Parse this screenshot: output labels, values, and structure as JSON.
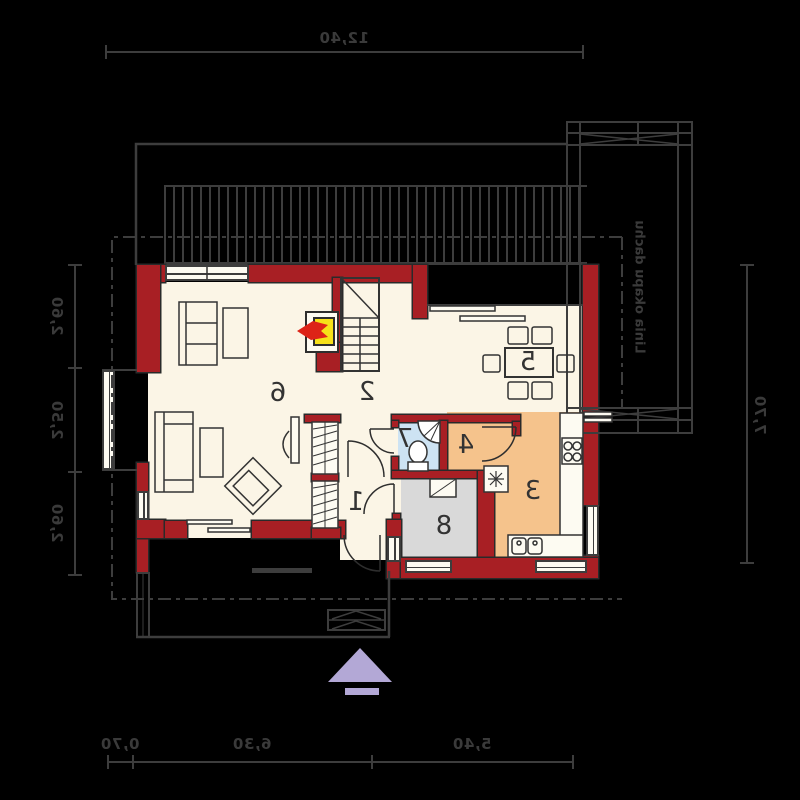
{
  "plan": {
    "dimensions": {
      "top": "12,40",
      "bottom": [
        "0,70",
        "6,30",
        "5,40"
      ],
      "left": [
        "2,60",
        "2,50",
        "2,60"
      ],
      "right": "7,70"
    },
    "eaves_label": "Linia okapu dachu",
    "rooms": {
      "hall": "1",
      "stair_hall": "2",
      "kitchen": "3",
      "pantry": "4",
      "dining": "5",
      "living": "6",
      "bathroom": "7",
      "vestibule": "8"
    },
    "colors": {
      "background": "#000000",
      "wall": "#a81f24",
      "floor": "#fbf5e6",
      "kitchen_floor": "#f5c38c",
      "bathroom_floor": "#cde3f3",
      "vestibule_floor": "#d9d9d9",
      "fireplace": "#f6e019",
      "flame": "#dd2317",
      "arrow": "#b3a8d6",
      "line": "#3d3d3d"
    }
  }
}
